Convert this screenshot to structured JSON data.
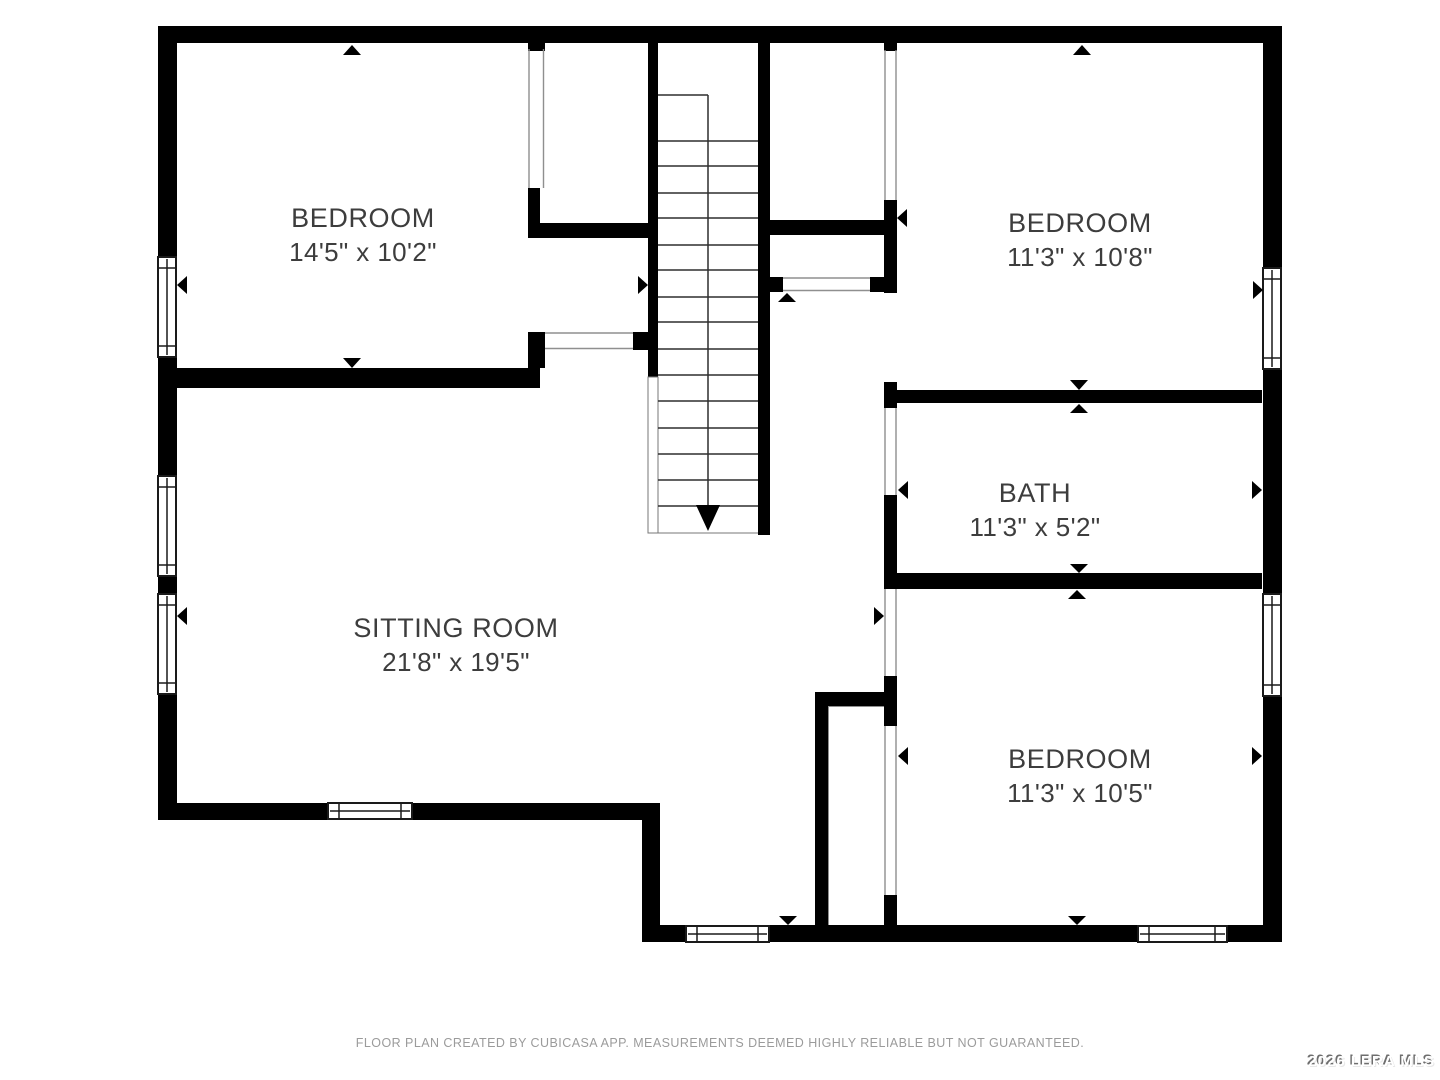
{
  "rooms": [
    {
      "name": "BEDROOM",
      "dims": "14'5\" x 10'2\""
    },
    {
      "name": "BEDROOM",
      "dims": "11'3\" x 10'8\""
    },
    {
      "name": "BATH",
      "dims": "11'3\" x 5'2\""
    },
    {
      "name": "SITTING ROOM",
      "dims": "21'8\" x 19'5\""
    },
    {
      "name": "BEDROOM",
      "dims": "11'3\" x 10'5\""
    }
  ],
  "footer": {
    "text": "FLOOR PLAN CREATED BY CUBICASA APP. MEASUREMENTS DEEMED HIGHLY RELIABLE BUT NOT GUARANTEED."
  },
  "watermark": {
    "text": "2026 LERA MLS"
  },
  "colors": {
    "wall": "#000000",
    "background": "#ffffff",
    "room_label": "#3d3d3d",
    "footer_text": "#9b9b9b",
    "opening_line": "#8f8f8f",
    "stair_line": "#2f2f2f"
  }
}
